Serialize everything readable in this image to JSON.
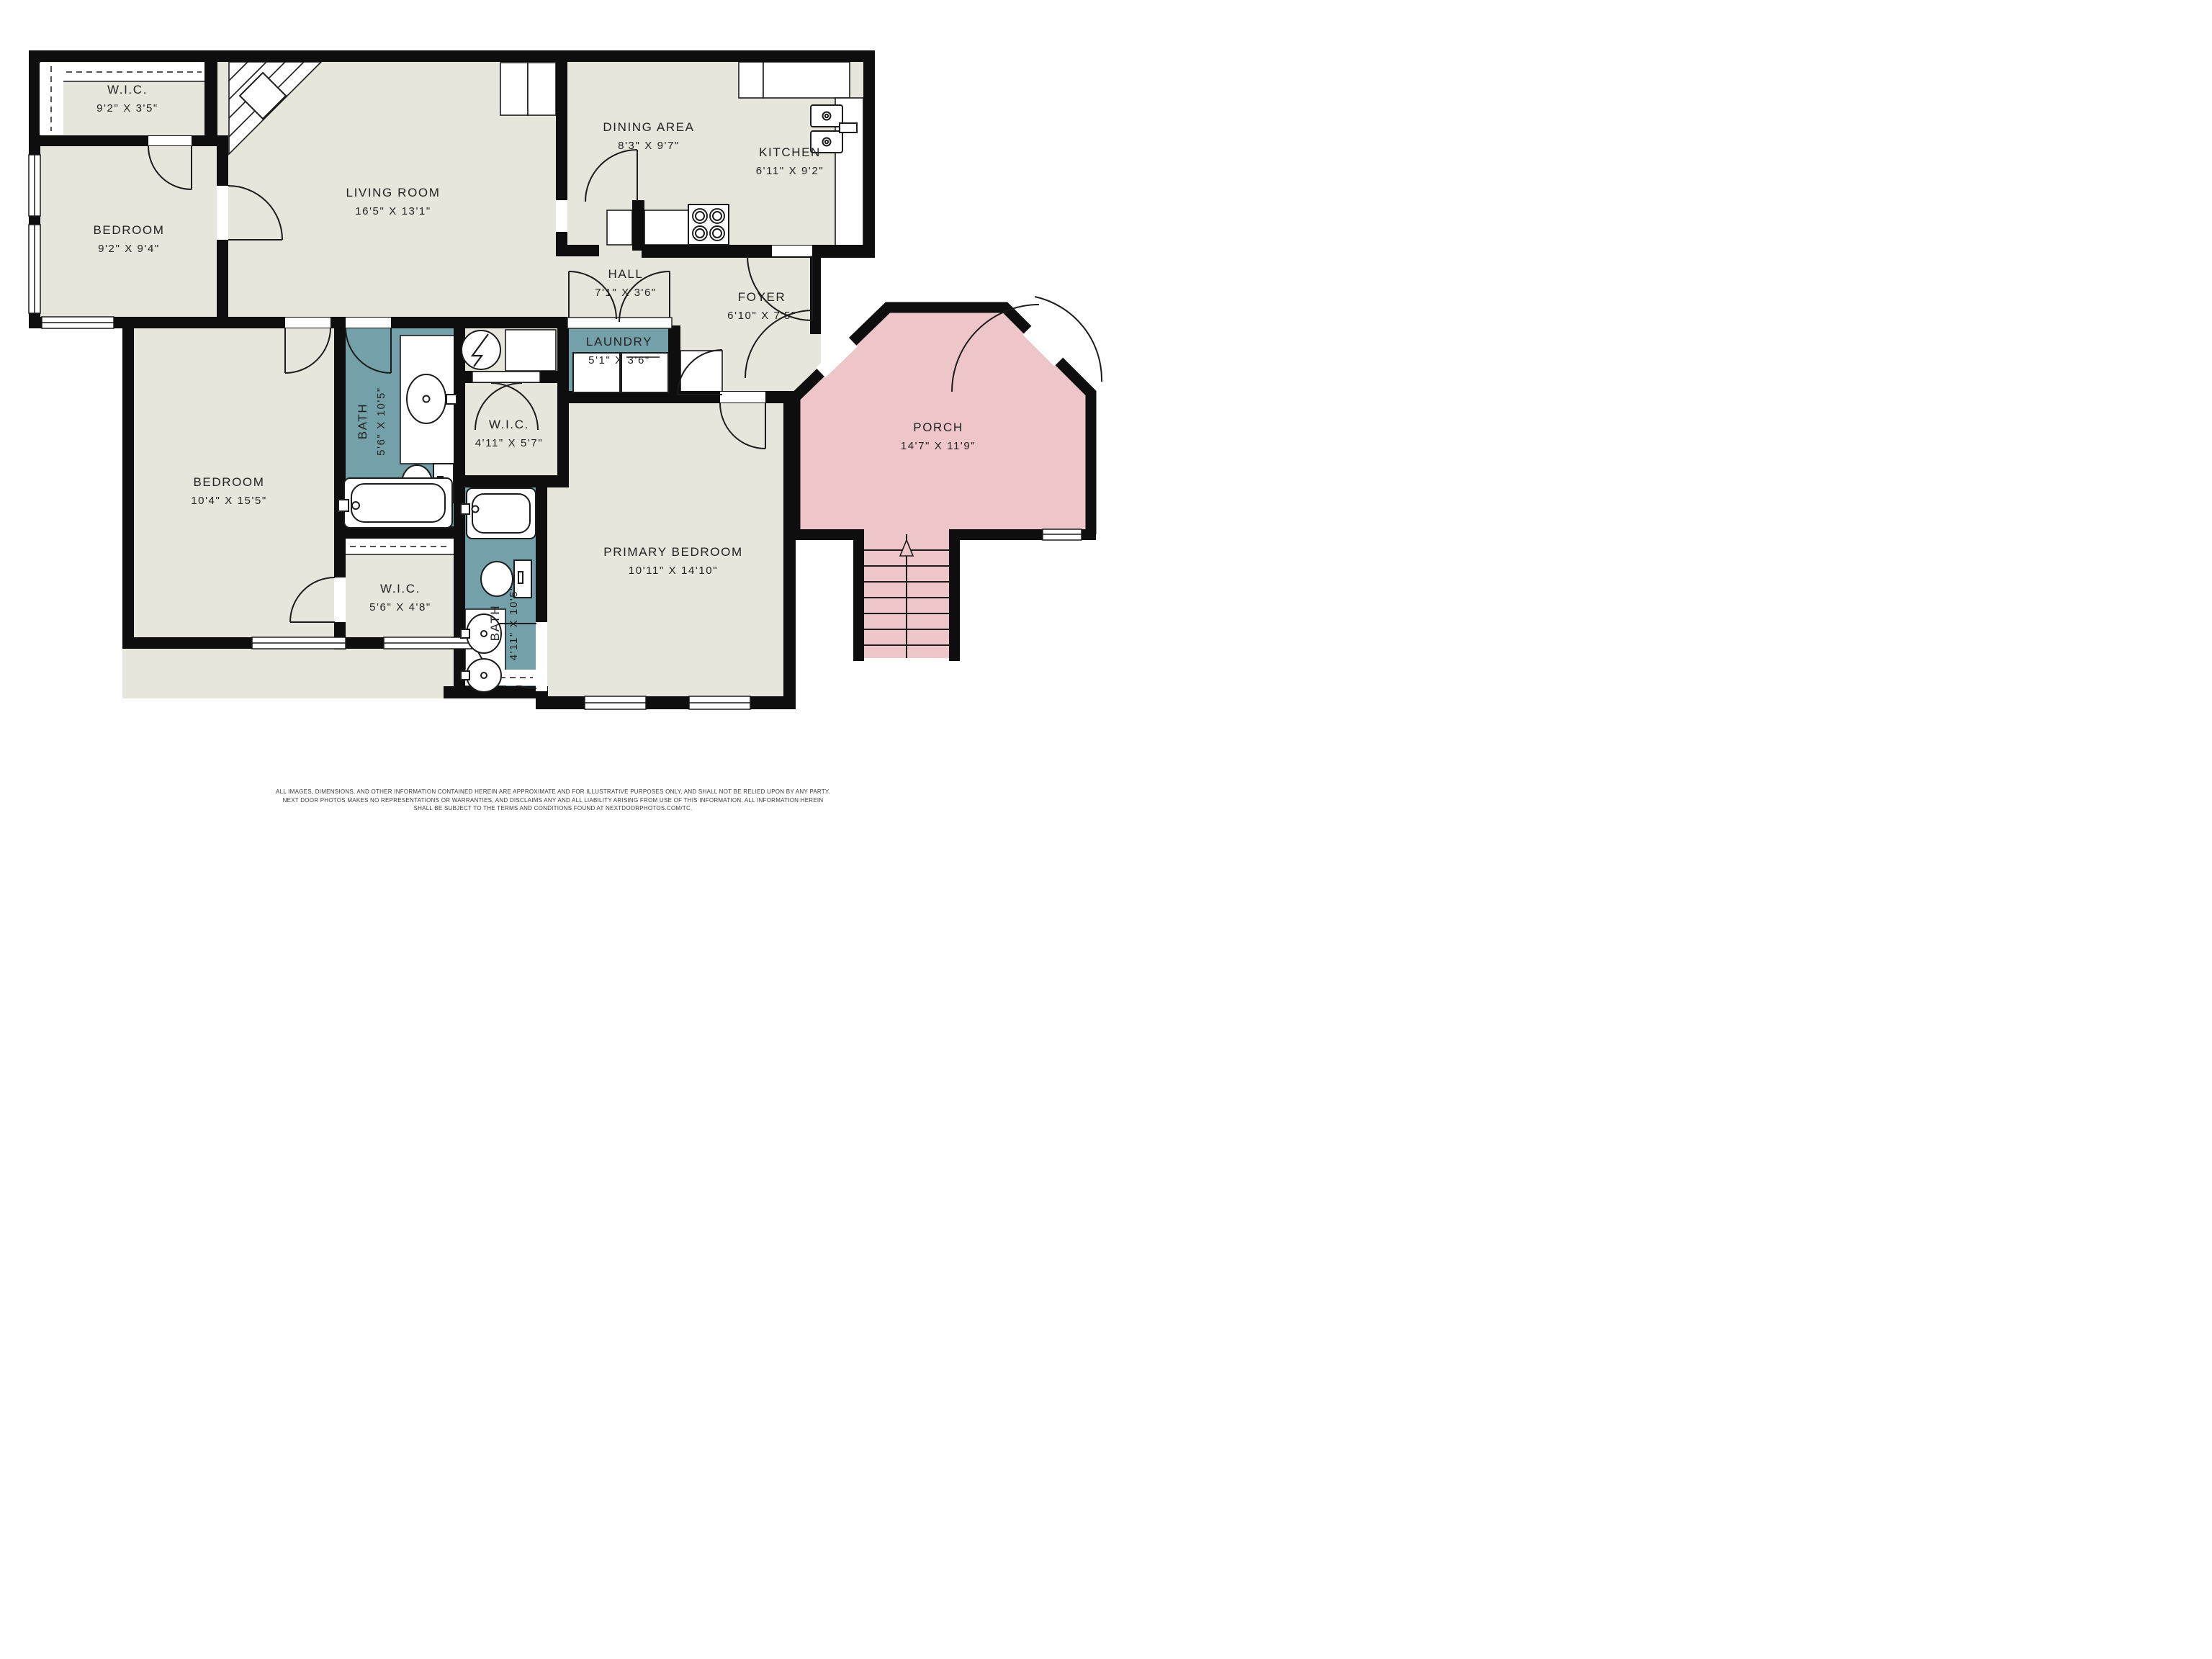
{
  "colors": {
    "floor": "#e7e6dc",
    "wet_room": "#74a0a9",
    "porch": "#eec5c8",
    "wall": "#0e0e0e",
    "background": "#ffffff"
  },
  "rooms": {
    "wic_top": {
      "name": "W.I.C.",
      "dims": "9'2\" X 3'5\""
    },
    "bedroom_tl": {
      "name": "BEDROOM",
      "dims": "9'2\" X 9'4\""
    },
    "living": {
      "name": "LIVING ROOM",
      "dims": "16'5\" X 13'1\""
    },
    "dining": {
      "name": "DINING AREA",
      "dims": "8'3\" X 9'7\""
    },
    "kitchen": {
      "name": "KITCHEN",
      "dims": "6'11\" X 9'2\""
    },
    "hall": {
      "name": "HALL",
      "dims": "7'1\" X 3'6\""
    },
    "foyer": {
      "name": "FOYER",
      "dims": "6'10\" X 7'5\""
    },
    "laundry": {
      "name": "LAUNDRY",
      "dims": "5'1\" X 3'6\""
    },
    "bath_upper": {
      "name": "BATH",
      "dims": "5'6\" X 10'5\""
    },
    "wic_mid": {
      "name": "W.I.C.",
      "dims": "4'11\" X 5'7\""
    },
    "bedroom_l": {
      "name": "BEDROOM",
      "dims": "10'4\" X 15'5\""
    },
    "wic_lower": {
      "name": "W.I.C.",
      "dims": "5'6\" X 4'8\""
    },
    "bath_lower": {
      "name": "BATH",
      "dims": "4'11\" X 10'5\""
    },
    "primary": {
      "name": "PRIMARY BEDROOM",
      "dims": "10'11\" X 14'10\""
    },
    "porch": {
      "name": "PORCH",
      "dims": "14'7\" X 11'9\""
    }
  },
  "icons": {
    "stairs_arrow": "up-arrow",
    "water_heater": "circle-with-lightning-bolt",
    "fireplace": "corner-hatch-with-diamond"
  },
  "disclaimer": {
    "line1": "ALL IMAGES, DIMENSIONS, AND OTHER INFORMATION CONTAINED HEREIN ARE APPROXIMATE AND FOR ILLUSTRATIVE PURPOSES ONLY, AND SHALL NOT BE RELIED UPON BY ANY PARTY.",
    "line2": "NEXT DOOR PHOTOS MAKES NO REPRESENTATIONS OR WARRANTIES, AND DISCLAIMS ANY AND ALL LIABILITY ARISING FROM USE OF THIS INFORMATION. ALL INFORMATION HEREIN",
    "line3": "SHALL BE SUBJECT TO THE TERMS AND CONDITIONS FOUND AT NEXTDOORPHOTOS.COM/TC."
  }
}
